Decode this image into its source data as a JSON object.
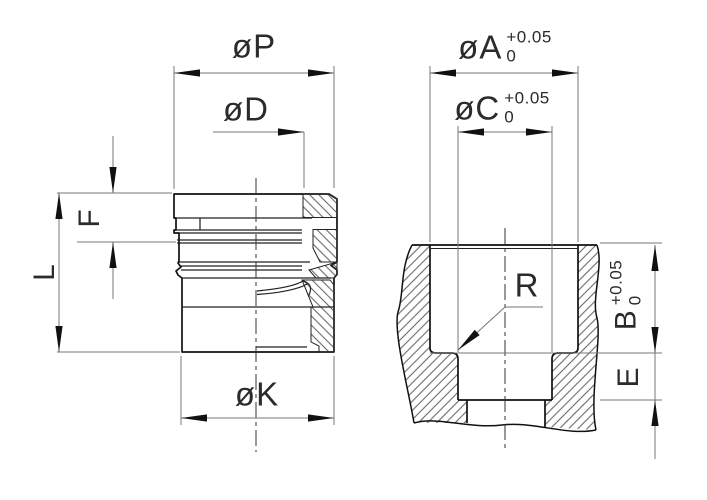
{
  "drawing": {
    "type": "engineering-dimension-drawing",
    "colors": {
      "background": "#ffffff",
      "outline": "#111111",
      "dimension_line": "#777777",
      "text": "#2b2b2b"
    },
    "dims": {
      "p": {
        "label": "øP"
      },
      "d": {
        "label": "øD"
      },
      "f": {
        "label": "F"
      },
      "l": {
        "label": "L"
      },
      "k": {
        "label": "øK"
      },
      "a": {
        "label": "øA",
        "tol_upper": "+0.05",
        "tol_lower": "0"
      },
      "c": {
        "label": "øC",
        "tol_upper": "+0.05",
        "tol_lower": "0"
      },
      "b": {
        "label": "B",
        "tol_upper": "+0.05",
        "tol_lower": "0"
      },
      "e": {
        "label": "E"
      },
      "r": {
        "label": "R"
      }
    }
  }
}
